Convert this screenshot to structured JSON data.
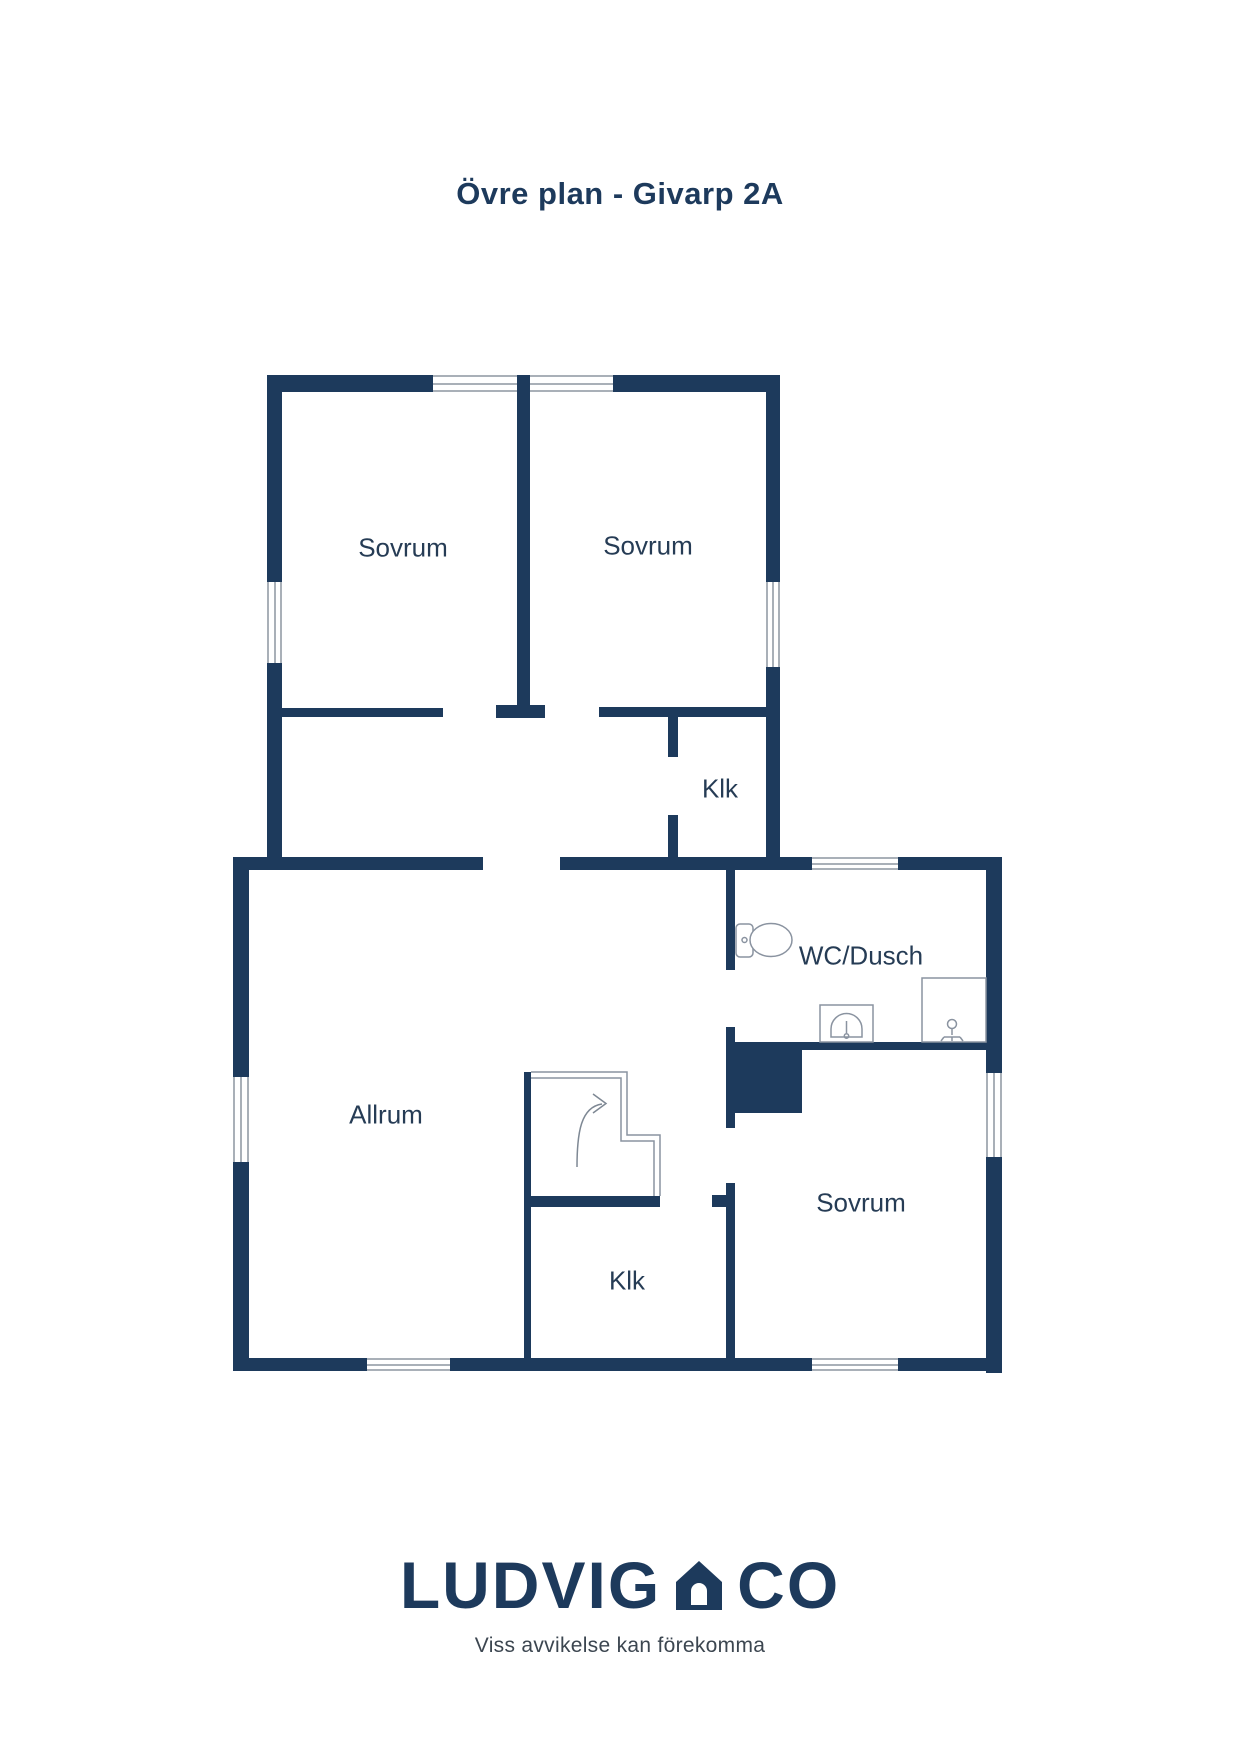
{
  "title": "Övre plan - Givarp 2A",
  "plan": {
    "rooms": {
      "sovrum_top_left": "Sovrum",
      "sovrum_top_right": "Sovrum",
      "klk_upper": "Klk",
      "wc_dusch": "WC/Dusch",
      "allrum": "Allrum",
      "sovrum_bottom": "Sovrum",
      "klk_lower": "Klk"
    },
    "fixtures": [
      "toilet-icon",
      "sink-icon",
      "shower-icon",
      "stairs-up-arrow"
    ]
  },
  "colors": {
    "wall": "#1d3a5c",
    "label_text": "#263c55",
    "fixture_line": "#8a93a0",
    "window_line": "#a9b0b8",
    "background": "#ffffff"
  },
  "footer": {
    "brand_left": "LUDVIG",
    "brand_right": "CO",
    "tagline": "Viss avvikelse kan förekomma"
  }
}
